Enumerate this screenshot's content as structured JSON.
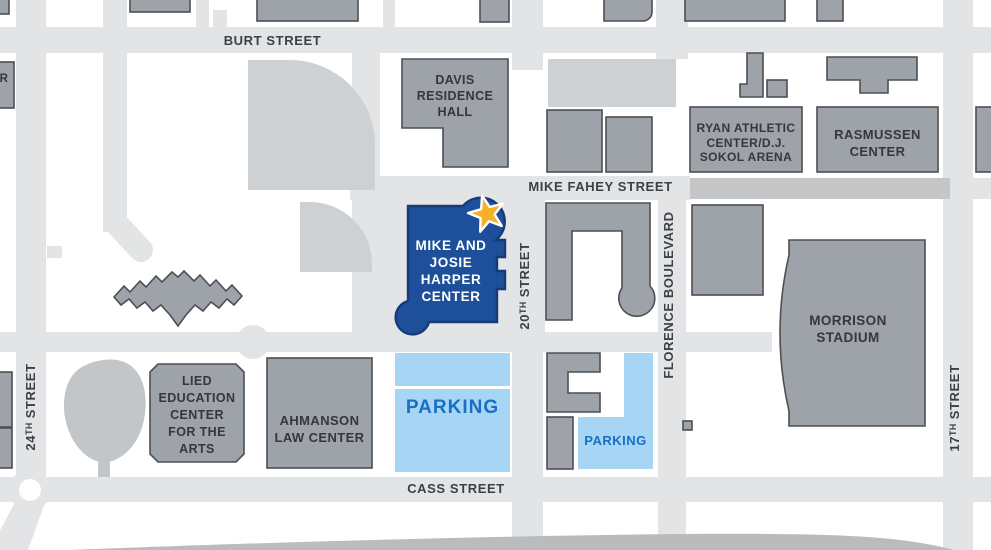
{
  "colors": {
    "road": "#e3e4e6",
    "road_dark": "#c4c6c8",
    "highway": "#b9bbbd",
    "building_fill": "#9ea3a9",
    "building_border": "#4c5054",
    "landscape": "#ced1d3",
    "tree": "#c3c6c9",
    "harper_blue": "#1d4f9b",
    "harper_border": "#163c77",
    "star_gold": "#f3b229",
    "parking_fill": "#a6d6f4",
    "parking_text": "#1a6fc4",
    "street_text": "#3d4145",
    "building_text": "#34373b"
  },
  "streets": {
    "burt": "BURT STREET",
    "mike_fahey": "MIKE FAHEY STREET",
    "cass": "CASS STREET",
    "street_24": "24ᵀᴴ STREET",
    "street_20": "20ᵀᴴ STREET",
    "florence": "FLORENCE BOULEVARD",
    "street_17": "17ᵀᴴ STREET"
  },
  "buildings": {
    "davis": "DAVIS\nRESIDENCE\nHALL",
    "ryan_sokol": "RYAN ATHLETIC\nCENTER/D.J.\nSOKOL ARENA",
    "rasmussen": "RASMUSSEN\nCENTER",
    "harper": "MIKE AND\nJOSIE\nHARPER\nCENTER",
    "morrison": "MORRISON\nSTADIUM",
    "lied": "LIED\nEDUCATION\nCENTER\nFOR THE\nARTS",
    "ahmanson": "AHMANSON\nLAW CENTER",
    "edge_fragment": "R"
  },
  "parking": {
    "lot1": "PARKING",
    "lot2": "PARKING"
  },
  "marker": {
    "icon": "star",
    "meaning": "Mike and Josie Harper Center highlighted location"
  }
}
